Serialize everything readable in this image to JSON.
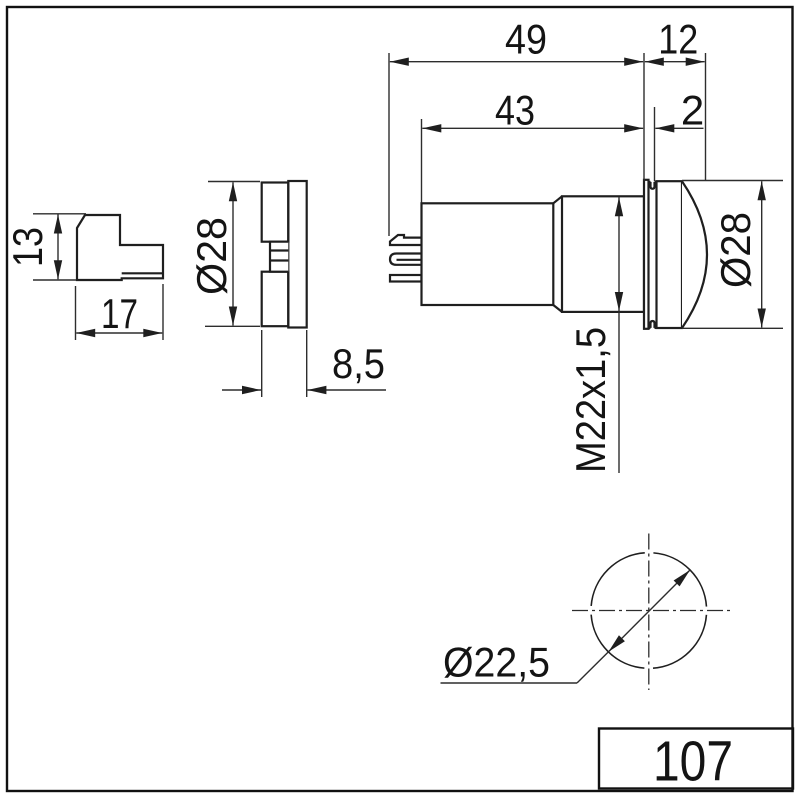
{
  "drawing": {
    "part_number": "107",
    "dims": {
      "bracket_height": "13",
      "bracket_width": "17",
      "cap_diameter": "Ø28",
      "cap_depth": "8,5",
      "total_length": "49",
      "front_length": "12",
      "body_length": "43",
      "flange_thickness": "2",
      "thread": "M22x1,5",
      "lens_diameter": "Ø28",
      "hole_diameter": "Ø22,5"
    }
  }
}
